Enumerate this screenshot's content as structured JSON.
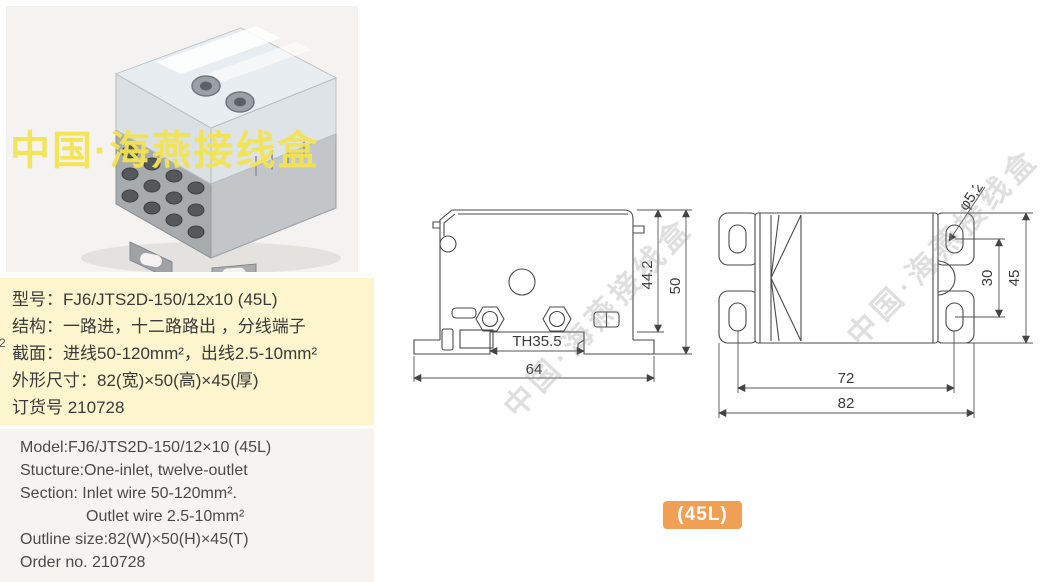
{
  "photo": {
    "watermark": "中国·海燕接线盒",
    "watermark_color": "#f2e350"
  },
  "specs_cn": {
    "bg": "#fcf5cd",
    "lines": [
      "型号：FJ6/JTS2D-150/12x10 (45L)",
      "结构：一路进，十二路路出 ，分线端子",
      "截面：进线50-120mm²，出线2.5-10mm²",
      "外形尺寸：82(宽)×50(高)×45(厚)",
      "订货号 210728"
    ]
  },
  "specs_en": {
    "lines": [
      "Model:FJ6/JTS2D-150/12×10 (45L)",
      "Stucture:One-inlet, twelve-outlet",
      "Section: Inlet wire 50-120mm².",
      "Outlet wire 2.5-10mm²",
      "Outline size:82(W)×50(H)×45(T)",
      "Order no. 210728"
    ]
  },
  "drawings": {
    "watermark": "中国·海燕接线盒",
    "side_view": {
      "rail_width": "TH35.5",
      "base_width": "64",
      "inner_height": "44.2",
      "total_height": "50"
    },
    "top_view": {
      "hole_diameter": "φ5,2",
      "hole_spacing_vertical": "30",
      "depth": "45",
      "hole_spacing_horizontal": "72",
      "total_width": "82"
    }
  },
  "badge": {
    "label": "(45L)",
    "bg": "#f0a055"
  },
  "edge_artifact": "2"
}
